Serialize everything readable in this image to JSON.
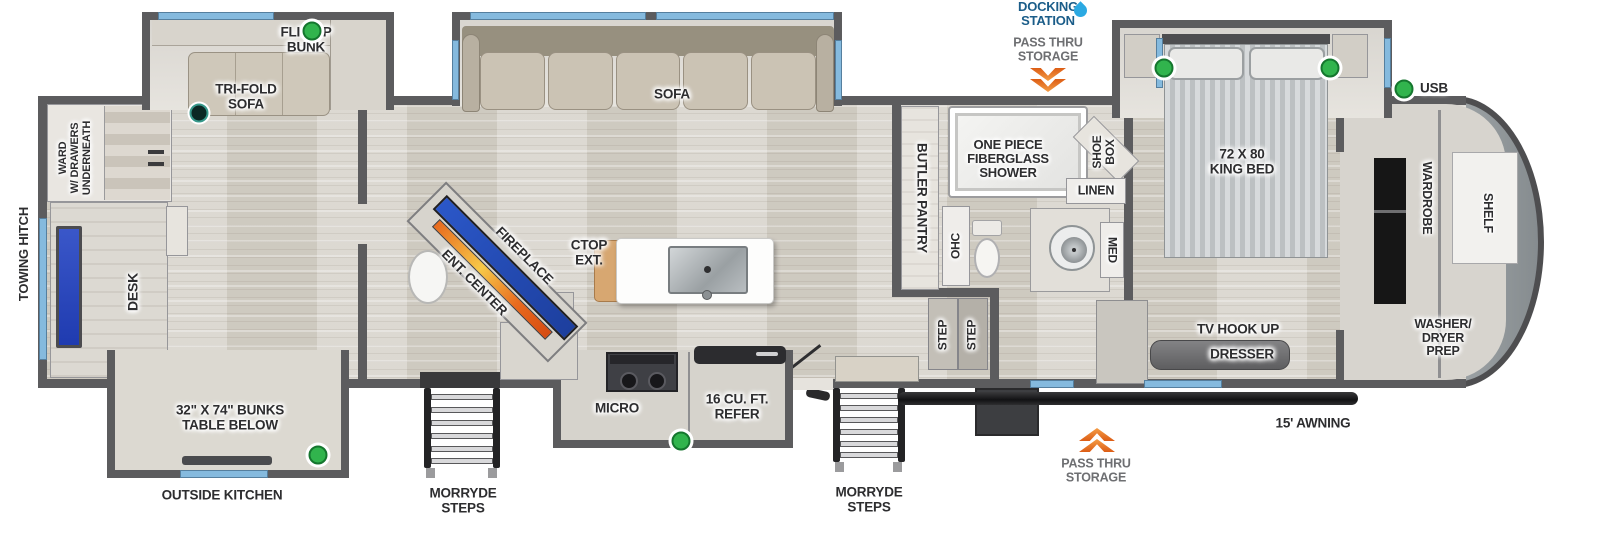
{
  "exterior": {
    "docking_station": "DOCKING\nSTATION",
    "pass_thru_top": "PASS THRU\nSTORAGE",
    "pass_thru_bottom": "PASS THRU\nSTORAGE",
    "awning": "15' AWNING",
    "towing_hitch": "TOWING HITCH",
    "morryde_steps": "MORRYDE\nSTEPS",
    "outside_kitchen": "OUTSIDE KITCHEN",
    "usb": "USB"
  },
  "rear_room": {
    "flip_up_bunk": "FLIP-UP\nBUNK",
    "tri_fold_sofa": "TRI-FOLD\nSOFA",
    "ward": "WARD\nW/ DRAWERS\nUNDERNEATH",
    "desk": "DESK",
    "bunks": "32\" X 74\" BUNKS\nTABLE BELOW"
  },
  "living": {
    "sofa": "SOFA",
    "ent_center": "ENT. CENTER",
    "fireplace": "FIREPLACE",
    "ctop_ext": "CTOP\nEXT.",
    "micro": "MICRO",
    "refer": "16 CU. FT.\nREFER"
  },
  "bath": {
    "shower": "ONE PIECE\nFIBERGLASS\nSHOWER",
    "butler_pantry": "BUTLER PANTRY",
    "ohc": "OHC",
    "shoe_box": "SHOE\nBOX",
    "linen": "LINEN",
    "med": "MED",
    "step": "STEP"
  },
  "bedroom": {
    "king_bed": "72 X 80\nKING BED",
    "tv_hook_up": "TV HOOK UP",
    "dresser": "DRESSER",
    "wardrobe": "WARDROBE",
    "shelf": "SHELF",
    "washer_dryer": "WASHER/\nDRYER\nPREP"
  },
  "colors": {
    "accent_green": "#31b44d",
    "window_blue": "#85bade",
    "arrow_orange": "#e87425",
    "docking_blue": "#1b5d89",
    "wall_gray": "#5c5c5e"
  }
}
